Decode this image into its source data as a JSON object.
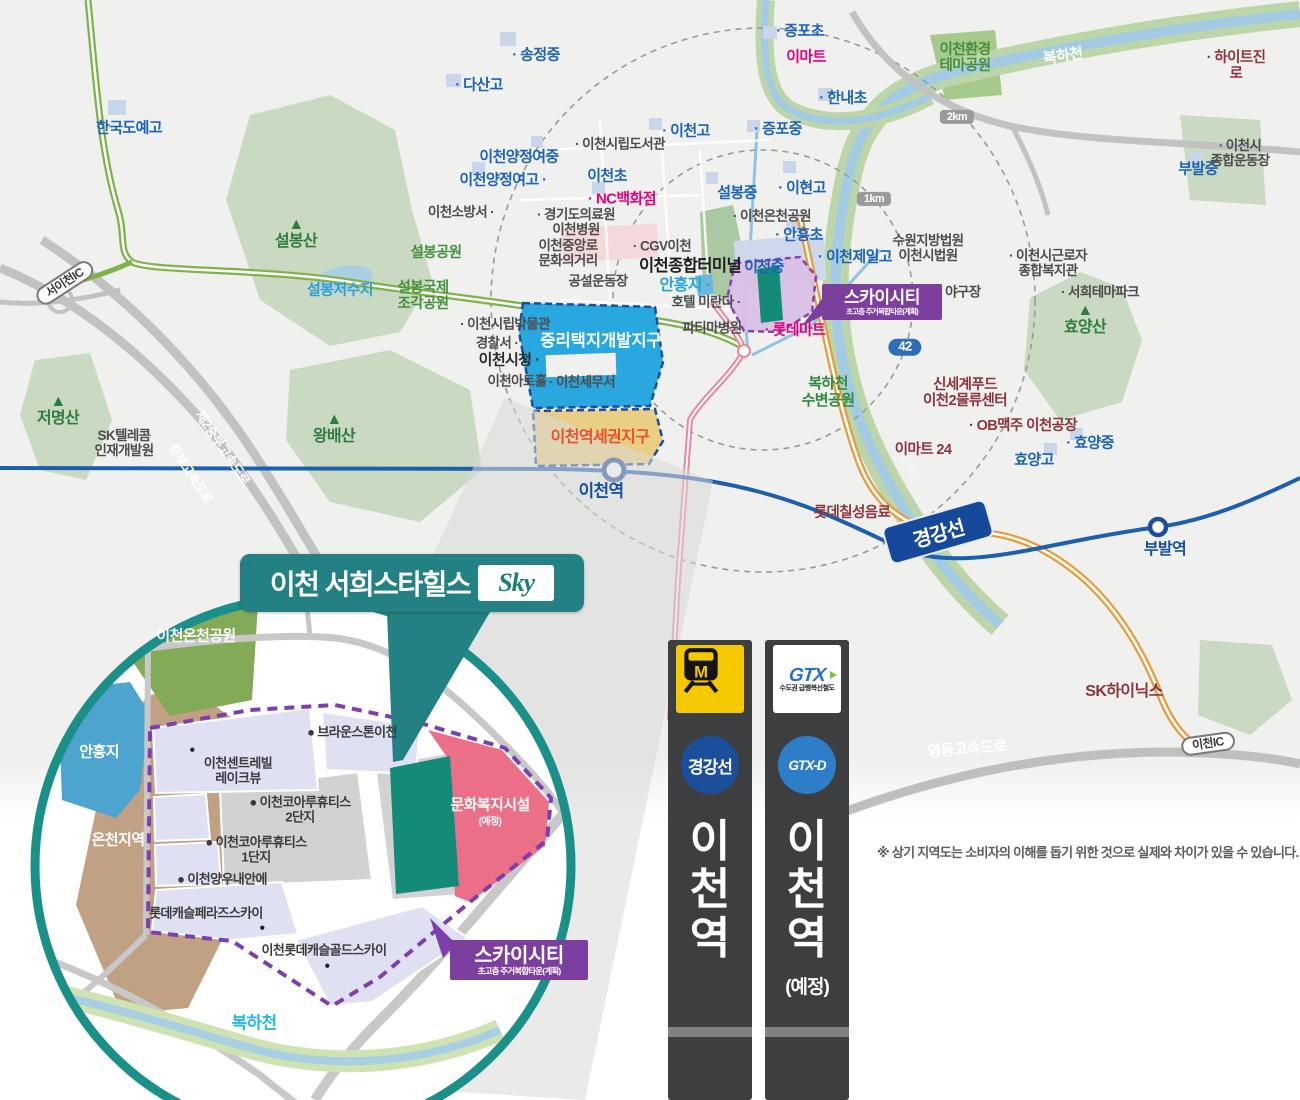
{
  "colors": {
    "banner_teal": "#238083",
    "inset_ring_teal": "#1b9088",
    "site_teal": "#148a78",
    "skycity_purple": "#7d3f9e",
    "boundary_purple": "#7d3fae",
    "culture_pink": "#ec6f88",
    "district_blue": "#29a7df",
    "district_tan": "#eace85",
    "rail_navy": "#1d5fae",
    "magenta": "#e5017d",
    "school_blue": "#1a63b8",
    "line_gg_blue": "#1b4e9b",
    "line_gtx_blue": "#2e7dc8",
    "metro_yellow": "#f6c800"
  },
  "banner": {
    "title": "이천 서희스타힐스",
    "logo": "Sky"
  },
  "badges": {
    "skycity_title": "스카이시티",
    "skycity_sub": "초고층 주거복합타운(계획)",
    "gyeonggang": "경강선"
  },
  "main_map": {
    "labels": [
      {
        "t": "· 송정중",
        "x": 536,
        "y": 56,
        "c": "school"
      },
      {
        "t": "· 다산고",
        "x": 479,
        "y": 86,
        "c": "school"
      },
      {
        "t": "한국도예고",
        "x": 129,
        "y": 129,
        "c": "school"
      },
      {
        "t": "· 증포초",
        "x": 800,
        "y": 32,
        "c": "school"
      },
      {
        "t": "이마트",
        "x": 806,
        "y": 58,
        "c": "mag"
      },
      {
        "t": "· 한내초",
        "x": 843,
        "y": 99,
        "c": "school"
      },
      {
        "t": "· 이천고",
        "x": 686,
        "y": 132,
        "c": "school"
      },
      {
        "t": "· 증포중",
        "x": 778,
        "y": 130,
        "c": "school"
      },
      {
        "t": "· 이현고",
        "x": 802,
        "y": 189,
        "c": "school"
      },
      {
        "t": "· 이천시립도서관",
        "x": 620,
        "y": 144,
        "c": "poi"
      },
      {
        "t": "이천양정여중",
        "x": 519,
        "y": 158,
        "c": "school"
      },
      {
        "t": "이천양정여고 ·",
        "x": 503,
        "y": 181,
        "c": "school"
      },
      {
        "t": "이천초",
        "x": 607,
        "y": 177,
        "c": "school"
      },
      {
        "t": "설봉중",
        "x": 737,
        "y": 194,
        "c": "school"
      },
      {
        "t": "이천소방서 ·",
        "x": 461,
        "y": 212,
        "c": "poi"
      },
      {
        "t": "· 경기도의료원\n이천병원",
        "x": 576,
        "y": 222,
        "c": "poi"
      },
      {
        "t": "· NC백화점",
        "x": 622,
        "y": 200,
        "c": "mag"
      },
      {
        "t": "이천중앙로\n문화의거리",
        "x": 568,
        "y": 253,
        "c": "poi"
      },
      {
        "t": "· CGV이천",
        "x": 662,
        "y": 246,
        "c": "poi"
      },
      {
        "t": "이천종합터미널",
        "x": 690,
        "y": 266,
        "c": "poib"
      },
      {
        "t": "· 이천온천공원",
        "x": 772,
        "y": 216,
        "c": "poi"
      },
      {
        "t": "공설운동장",
        "x": 598,
        "y": 281,
        "c": "poi"
      },
      {
        "t": "안흥지 ·",
        "x": 685,
        "y": 286,
        "c": "cyan"
      },
      {
        "t": "호텔 미란다 ·",
        "x": 706,
        "y": 302,
        "c": "poi"
      },
      {
        "t": "파티마병원",
        "x": 712,
        "y": 328,
        "c": "poi"
      },
      {
        "t": "· 안흥초",
        "x": 799,
        "y": 236,
        "c": "school"
      },
      {
        "t": "이천중",
        "x": 764,
        "y": 268,
        "c": "school"
      },
      {
        "t": "· 이천제일고",
        "x": 855,
        "y": 258,
        "c": "school"
      },
      {
        "t": "수원지방법원\n이천시법원",
        "x": 928,
        "y": 248,
        "c": "poi"
      },
      {
        "t": "· 이천시근로자\n종합복지관",
        "x": 1048,
        "y": 263,
        "c": "poi"
      },
      {
        "t": "· 서희테마파크",
        "x": 1100,
        "y": 292,
        "c": "poi"
      },
      {
        "t": "· 복하천 야구장",
        "x": 940,
        "y": 292,
        "c": "poi"
      },
      {
        "t": "▲\n효양산",
        "x": 1085,
        "y": 320,
        "c": "mtn"
      },
      {
        "t": "이천환경\n테마공원",
        "x": 965,
        "y": 58,
        "c": "grn"
      },
      {
        "t": "복하천",
        "x": 1063,
        "y": 57,
        "c": "whitel",
        "r": -8
      },
      {
        "t": "· 하이트진로",
        "x": 1236,
        "y": 66,
        "c": "red"
      },
      {
        "t": "부발중",
        "x": 1198,
        "y": 170,
        "c": "school"
      },
      {
        "t": "· 이천시\n종합운동장",
        "x": 1240,
        "y": 153,
        "c": "poi"
      },
      {
        "t": "설봉공원",
        "x": 436,
        "y": 253,
        "c": "grn"
      },
      {
        "t": "설봉국제\n조각공원",
        "x": 423,
        "y": 296,
        "c": "grn"
      },
      {
        "t": "설봉저수지",
        "x": 340,
        "y": 291,
        "c": "water"
      },
      {
        "t": "· 이천시립박물관",
        "x": 505,
        "y": 324,
        "c": "poi"
      },
      {
        "t": "경찰서 ·",
        "x": 497,
        "y": 343,
        "c": "poi"
      },
      {
        "t": "이천시청 ·",
        "x": 509,
        "y": 361,
        "c": "poib2"
      },
      {
        "t": "이천아트홀",
        "x": 517,
        "y": 381,
        "c": "poi"
      },
      {
        "t": "· 이천세무서",
        "x": 582,
        "y": 382,
        "c": "poi"
      },
      {
        "t": "▲\n설봉산",
        "x": 296,
        "y": 234,
        "c": "mtn"
      },
      {
        "t": "▲\n왕배산",
        "x": 334,
        "y": 429,
        "c": "mtn"
      },
      {
        "t": "▲\n저명산",
        "x": 58,
        "y": 411,
        "c": "mtn"
      },
      {
        "t": "SK텔레콤\n인재개발원",
        "x": 124,
        "y": 443,
        "c": "poi"
      },
      {
        "t": "제2중부고속도로",
        "x": 222,
        "y": 448,
        "c": "hwy",
        "r": 56
      },
      {
        "t": "중부고속도로",
        "x": 190,
        "y": 474,
        "c": "hwy",
        "r": 56
      },
      {
        "t": "중리택지개발지구",
        "x": 601,
        "y": 341,
        "c": "distw"
      },
      {
        "t": "이천역세권지구",
        "x": 600,
        "y": 438,
        "c": "orange"
      },
      {
        "t": "이천역",
        "x": 601,
        "y": 491,
        "c": "navy"
      },
      {
        "t": "복하천\n수변공원",
        "x": 828,
        "y": 393,
        "c": "grnb"
      },
      {
        "t": "신세계푸드\n이천2물류센터",
        "x": 965,
        "y": 393,
        "c": "red"
      },
      {
        "t": "· OB맥주 이천공장",
        "x": 1023,
        "y": 426,
        "c": "red"
      },
      {
        "t": "이마트 24",
        "x": 923,
        "y": 450,
        "c": "red"
      },
      {
        "t": "· 효양중",
        "x": 1090,
        "y": 444,
        "c": "school"
      },
      {
        "t": "효양고",
        "x": 1034,
        "y": 461,
        "c": "school"
      },
      {
        "t": "롯데칠성음료",
        "x": 852,
        "y": 513,
        "c": "red"
      },
      {
        "t": "부발역",
        "x": 1165,
        "y": 550,
        "c": "school2"
      },
      {
        "t": "복하천",
        "x": 908,
        "y": 470,
        "c": "whites",
        "r": 62
      },
      {
        "t": "SK하이닉스",
        "x": 1124,
        "y": 692,
        "c": "redb"
      },
      {
        "t": "영동고속도로",
        "x": 967,
        "y": 750,
        "c": "hwy2",
        "r": -4
      },
      {
        "t": "· 롯데마트",
        "x": 795,
        "y": 331,
        "c": "mag"
      },
      {
        "t": "서이천IC",
        "x": 65,
        "y": 283,
        "c": "pill",
        "r": -33
      },
      {
        "t": "이천IC",
        "x": 1208,
        "y": 744,
        "c": "pill",
        "r": -8
      },
      {
        "t": "1km",
        "x": 874,
        "y": 199,
        "c": "km"
      },
      {
        "t": "2km",
        "x": 957,
        "y": 117,
        "c": "km"
      },
      {
        "t": "42",
        "x": 905,
        "y": 347,
        "c": "b42"
      }
    ]
  },
  "inset": {
    "labels": [
      {
        "t": "이천온천공원",
        "x": 196,
        "y": 637,
        "c": "white2"
      },
      {
        "t": "안흥지",
        "x": 99,
        "y": 753,
        "c": "white2"
      },
      {
        "t": "온천지역",
        "x": 118,
        "y": 841,
        "c": "white2"
      },
      {
        "t": "● 브라운스톤이천",
        "x": 352,
        "y": 733,
        "c": "ins"
      },
      {
        "t": "●",
        "x": 192,
        "y": 750,
        "c": "dot"
      },
      {
        "t": "이천센트레빌\n레이크뷰",
        "x": 238,
        "y": 771,
        "c": "ins"
      },
      {
        "t": "● 이천코아루휴티스\n2단지",
        "x": 300,
        "y": 810,
        "c": "ins"
      },
      {
        "t": "● 이천코아루휴티스\n1단지",
        "x": 256,
        "y": 850,
        "c": "ins"
      },
      {
        "t": "● 이천양우내안에",
        "x": 222,
        "y": 880,
        "c": "ins"
      },
      {
        "t": "롯데캐슬페라즈스카이",
        "x": 206,
        "y": 914,
        "c": "ins"
      },
      {
        "t": "●",
        "x": 262,
        "y": 928,
        "c": "dot"
      },
      {
        "t": "이천롯데캐슬골드스카이",
        "x": 324,
        "y": 951,
        "c": "ins"
      },
      {
        "t": "●",
        "x": 327,
        "y": 966,
        "c": "dot"
      },
      {
        "t": "문화복지시설",
        "x": 490,
        "y": 806,
        "c": "white2"
      },
      {
        "t": "(예정)",
        "x": 490,
        "y": 822,
        "c": "white3"
      },
      {
        "t": "복하천",
        "x": 254,
        "y": 1023,
        "c": "cyanb"
      }
    ]
  },
  "transit_signs": {
    "left": {
      "icon_letter": "M",
      "line_badge": "경강선",
      "station": "이\n천\n역"
    },
    "right": {
      "logo": "GTX",
      "logo_sub": "수도권 급행복선철도",
      "line_badge": "GTX-D",
      "station": "이\n천\n역",
      "note": "(예정)"
    }
  },
  "disclaimer": "※ 상기 지역도는 소비자의 이해를 돕기 위한 것으로 실제와 차이가 있을 수 있습니다."
}
